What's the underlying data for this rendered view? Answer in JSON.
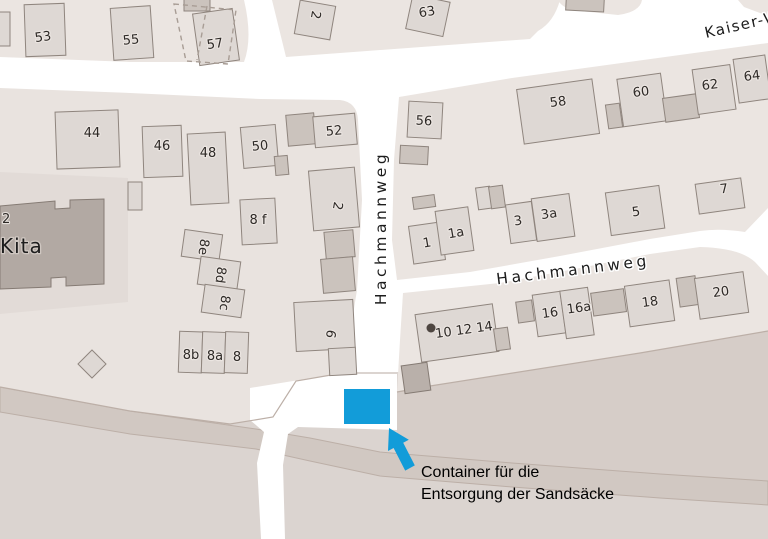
{
  "streets": {
    "hachmannweg_vertical": "Hachmannweg",
    "hachmannweg_horizontal": "Hachmannweg",
    "kaiser_partial": "Kaiser-W"
  },
  "poi": {
    "kita": "Kita",
    "kita_housenumber": "2"
  },
  "houses": {
    "h53": "53",
    "h55": "55",
    "h57": "57",
    "h2_top": "2",
    "h63": "63",
    "h44": "44",
    "h46": "46",
    "h48": "48",
    "h50": "50",
    "h52": "52",
    "h8f": "8 f",
    "h8e": "8e",
    "h8d": "8d",
    "h8c": "8c",
    "h8b": "8b",
    "h8a": "8a",
    "h8": "8",
    "h2_mid": "2",
    "h6": "6",
    "h56": "56",
    "h58": "58",
    "h60": "60",
    "h62": "62",
    "h64": "64",
    "h7": "7",
    "h1": "1",
    "h1a": "1a",
    "h3": "3",
    "h3a": "3a",
    "h5": "5",
    "h16": "16",
    "h16a": "16a",
    "h18": "18",
    "h20": "20",
    "h10_12_14": "10 12 14"
  },
  "annotation": {
    "line1": "Container für die",
    "line2": "Entsorgung der Sandsäcke"
  },
  "colors": {
    "marker_blue": "#129cd9",
    "road_white": "#ffffff",
    "block_beige": "#ebe5e1",
    "building_gray": "#ded8d4",
    "kita_building": "#b2a9a3",
    "poi_dot": "#4d4540"
  }
}
